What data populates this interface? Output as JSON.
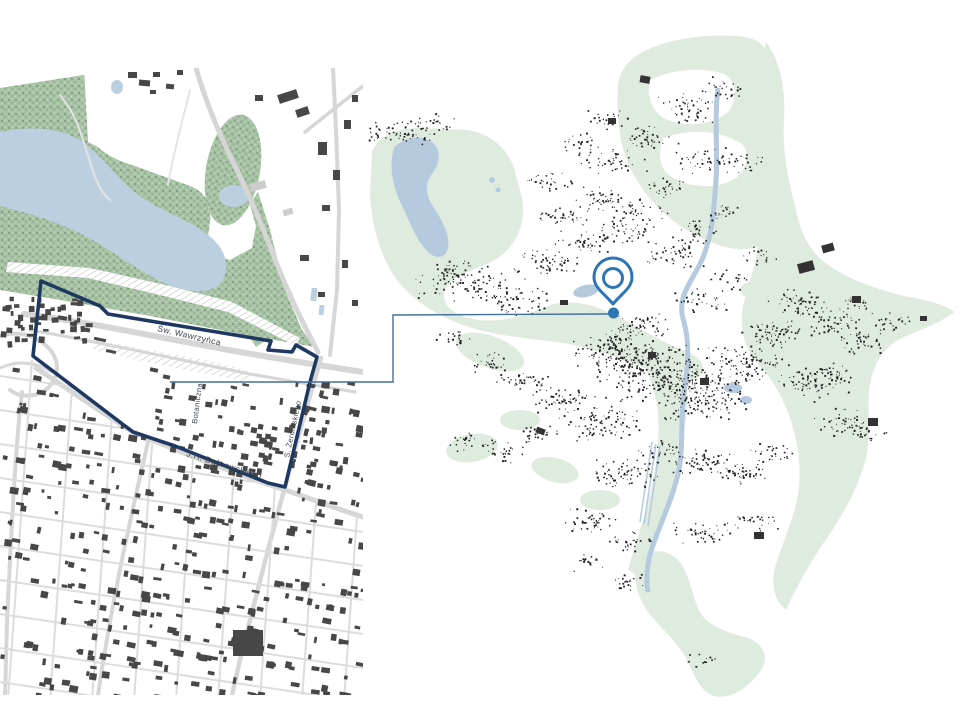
{
  "slide": {
    "background": "#FFFFFF"
  },
  "left_map": {
    "name": "detail-map-with-site-boundary",
    "street_labels": [
      {
        "id": "wawrzynca",
        "text": "Św. Wawrzyńca"
      },
      {
        "id": "botaniczna",
        "text": "Botaniczna"
      },
      {
        "id": "dabrowskiego",
        "text": "J.H. Dąbrowskiego"
      },
      {
        "id": "zeromskiego",
        "text": "S. Żeromskiego"
      }
    ],
    "colors": {
      "forest": "#A7C2A4",
      "forest_dot": "#7E9F7E",
      "water": "#BCCFE0",
      "road": "#D6D6D6",
      "building": "#474747",
      "boundary": "#1E3862",
      "label": "#3F4650",
      "hatch": "#BFBFBF"
    }
  },
  "right_map": {
    "name": "city-overview-map",
    "colors": {
      "green": "#E0EBDF",
      "water": "#B5CADE",
      "building": "#1F1F1F",
      "dark_block": "#333333"
    }
  },
  "marker": {
    "color": "#2E75B6",
    "fill": "#FFFFFF"
  },
  "connector": {
    "color": "#41719C"
  }
}
